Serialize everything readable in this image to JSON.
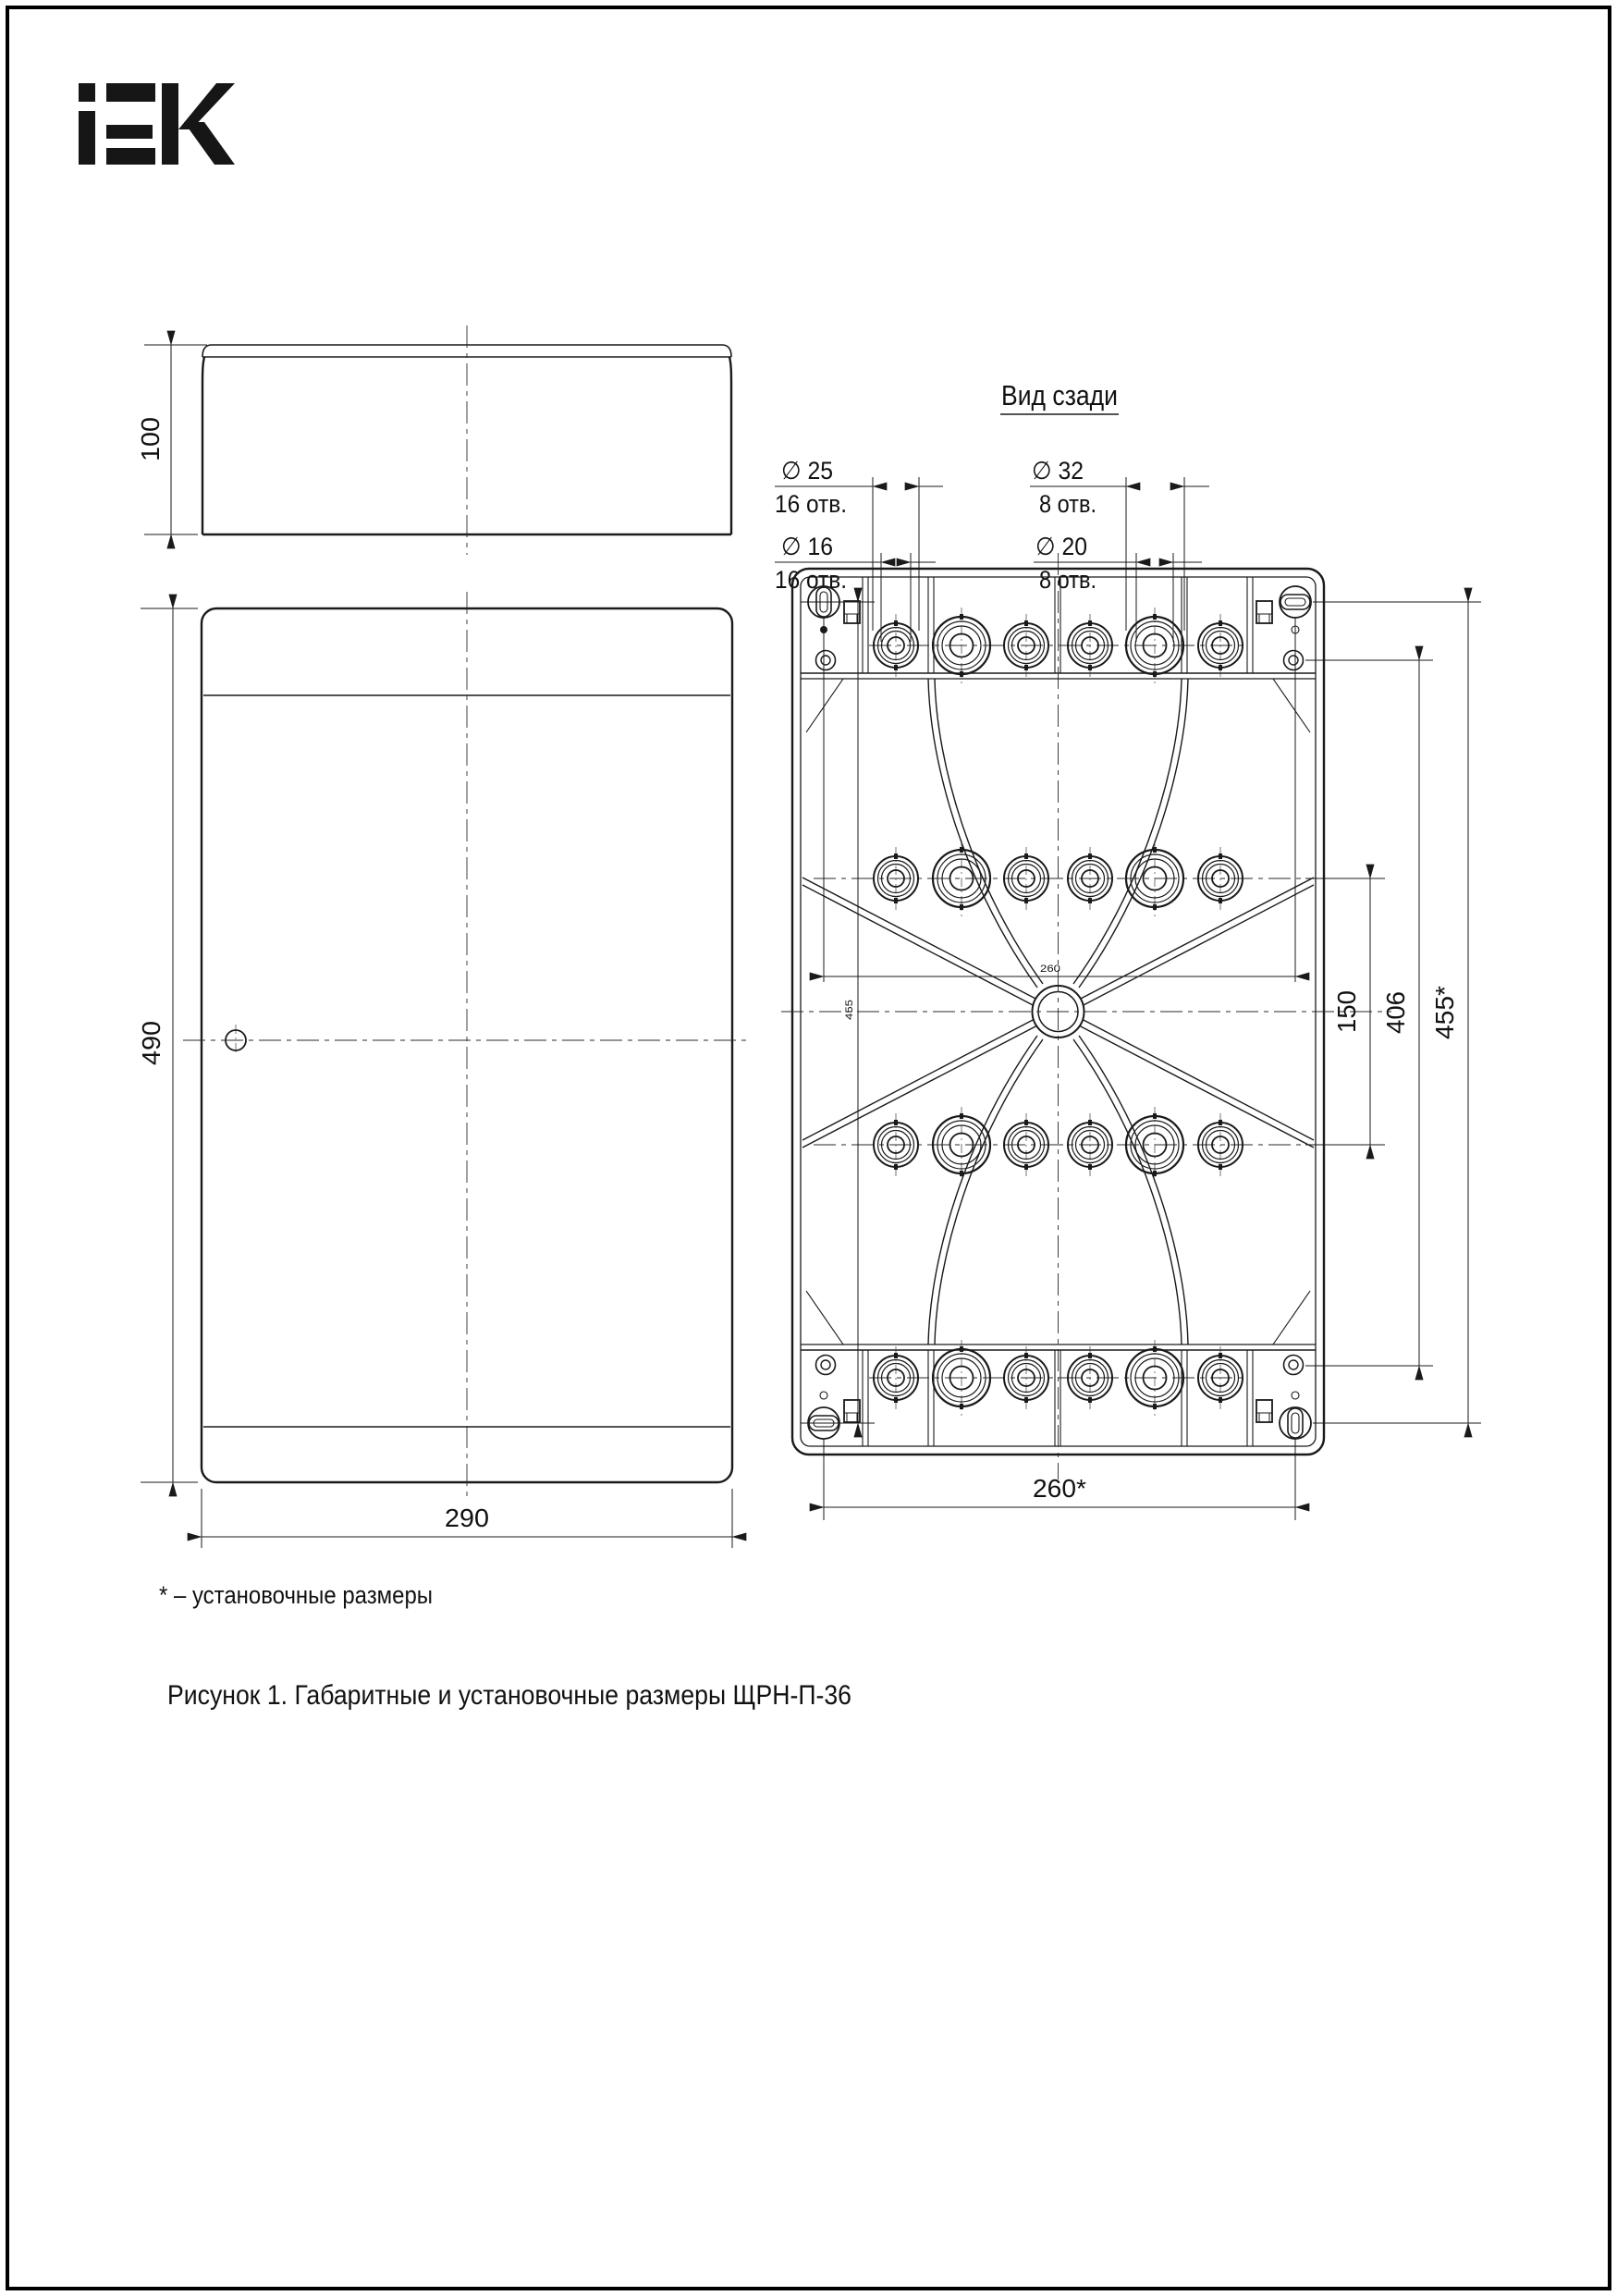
{
  "brand": {
    "logo_text": "IEK"
  },
  "rear_view": {
    "title": "Вид сзади",
    "callouts": {
      "d25": {
        "label": "∅ 25",
        "holes": "16 отв."
      },
      "d16": {
        "label": "∅ 16",
        "holes": "16 отв."
      },
      "d32": {
        "label": "∅ 32",
        "holes": "8 отв."
      },
      "d20": {
        "label": "∅ 20",
        "holes": "8 отв."
      }
    },
    "dimensions": {
      "mount_width": "260*",
      "mount_height": "455*",
      "holes_span": "406",
      "rows_gap": "150",
      "inner_width": "260",
      "inner_height": "455"
    }
  },
  "side_view": {
    "dimensions": {
      "depth": "100"
    }
  },
  "front_view": {
    "dimensions": {
      "height": "490",
      "width": "290"
    }
  },
  "footnote": "* – установочные размеры",
  "caption": "Рисунок 1. Габаритные и установочные размеры ЩРН-П-36",
  "colors": {
    "line": "#1a1a1a",
    "background": "#ffffff"
  }
}
